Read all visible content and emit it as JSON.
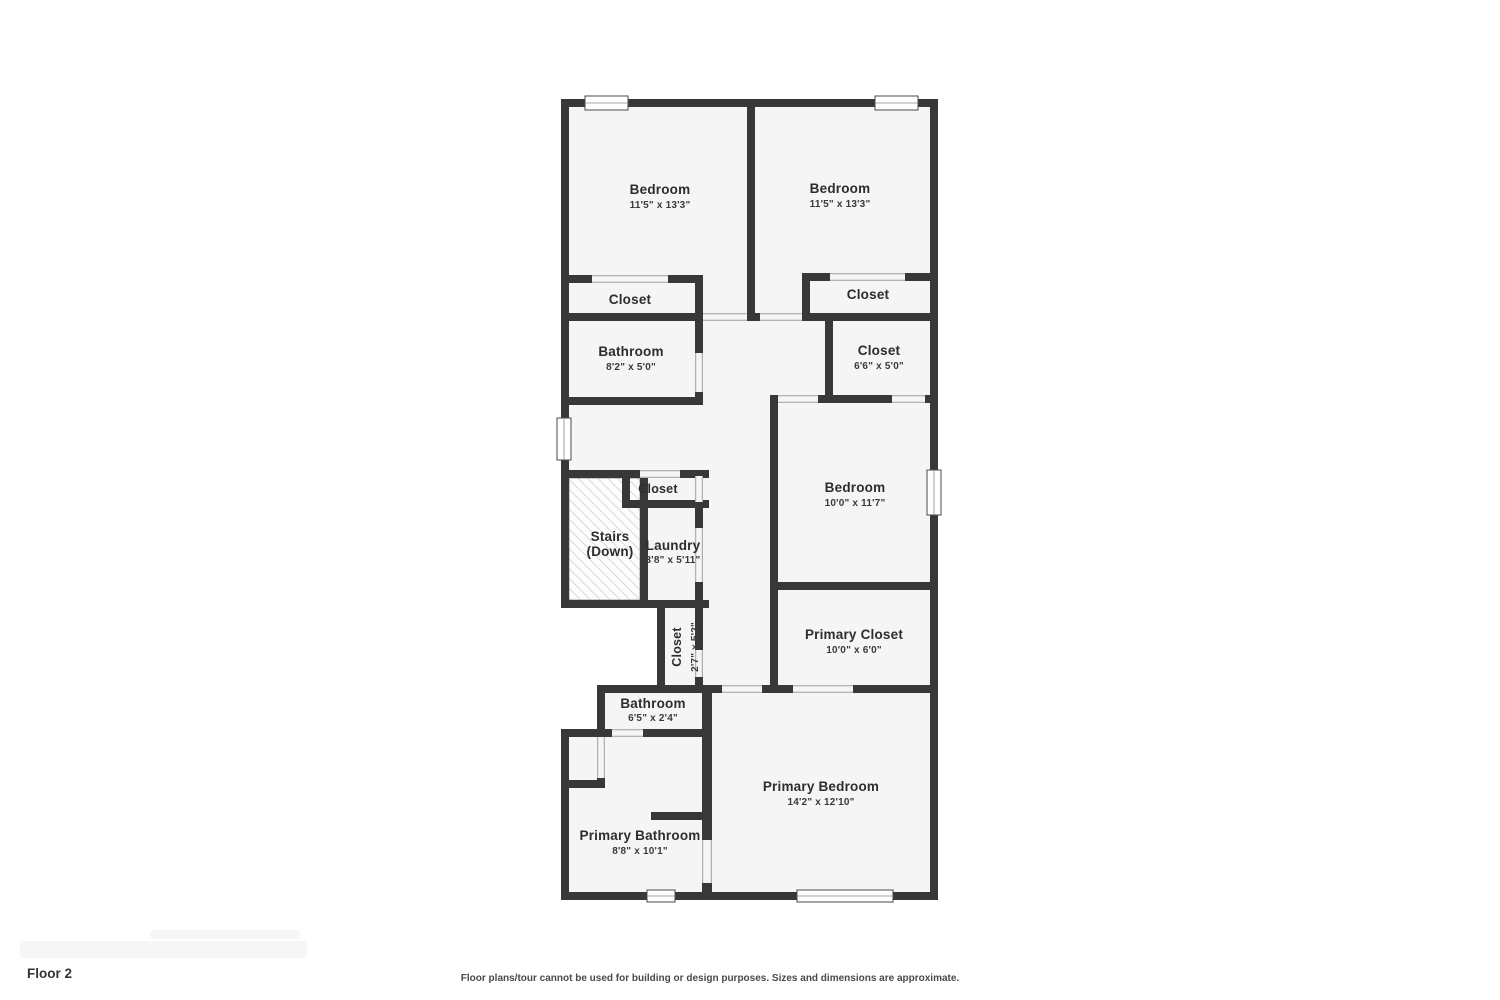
{
  "floor": {
    "label": "Floor 2"
  },
  "footer": {
    "disclaimer": "Floor plans/tour cannot be used for building or design purposes. Sizes and dimensions are approximate."
  },
  "colors": {
    "wall": "#383838",
    "room_fill": "#f5f5f5",
    "label_text": "#2d2d2d",
    "dims_text": "#3a3a3a"
  },
  "rooms": {
    "bedroom_top_left": {
      "name": "Bedroom",
      "dims": "11'5\" x 13'3\""
    },
    "bedroom_top_right": {
      "name": "Bedroom",
      "dims": "11'5\" x 13'3\""
    },
    "closet_top_left": {
      "name": "Closet"
    },
    "closet_top_right": {
      "name": "Closet"
    },
    "bathroom_upper": {
      "name": "Bathroom",
      "dims": "8'2\" x 5'0\""
    },
    "closet_mid_right": {
      "name": "Closet",
      "dims": "6'6\" x 5'0\""
    },
    "closet_hall": {
      "name": "Closet"
    },
    "stairs": {
      "name": "Stairs",
      "sub": "(Down)"
    },
    "laundry": {
      "name": "Laundry",
      "dims": "3'8\" x 5'11\""
    },
    "bedroom_middle": {
      "name": "Bedroom",
      "dims": "10'0\" x 11'7\""
    },
    "closet_vertical": {
      "name": "Closet",
      "dims": "2'7\" x 5'2\""
    },
    "primary_closet": {
      "name": "Primary Closet",
      "dims": "10'0\" x 6'0\""
    },
    "bathroom_small": {
      "name": "Bathroom",
      "dims": "6'5\" x 2'4\""
    },
    "primary_bathroom": {
      "name": "Primary Bathroom",
      "dims": "8'8\" x 10'1\""
    },
    "primary_bedroom": {
      "name": "Primary Bedroom",
      "dims": "14'2\" x 12'10\""
    }
  }
}
